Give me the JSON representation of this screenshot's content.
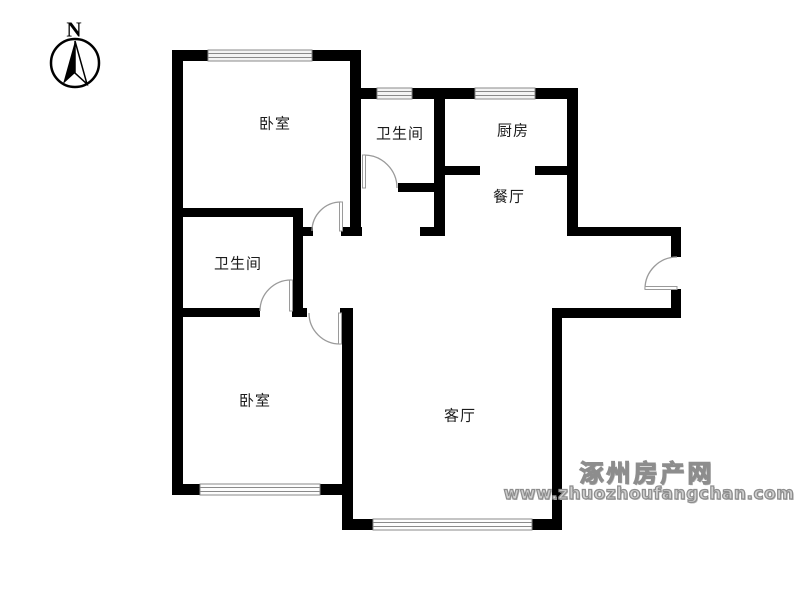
{
  "compass": {
    "north": "N"
  },
  "rooms": {
    "bedroom_top": {
      "label": "卧室"
    },
    "bathroom_top": {
      "label": "卫生间"
    },
    "kitchen": {
      "label": "厨房"
    },
    "dining": {
      "label": "餐厅"
    },
    "bathroom_mid": {
      "label": "卫生间"
    },
    "bedroom_bottom": {
      "label": "卧室"
    },
    "living": {
      "label": "客厅"
    }
  },
  "watermark": {
    "site_name": "涿州房产网",
    "site_url": "www.zhuozhoufangchan.com"
  },
  "colors": {
    "wall": "#000000",
    "door": "#9a9a9a",
    "window_line": "#8a8a8a",
    "watermark": "#8d8d8d"
  }
}
